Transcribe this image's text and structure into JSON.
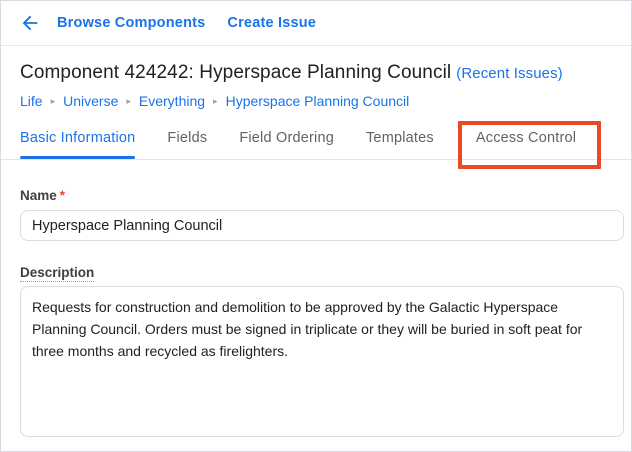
{
  "topbar": {
    "back_icon": "arrow-left",
    "browse_components_label": "Browse Components",
    "create_issue_label": "Create Issue"
  },
  "header": {
    "title": "Component 424242: Hyperspace Planning Council",
    "recent_issues_label": "(Recent Issues)"
  },
  "breadcrumb": {
    "separator": "▸",
    "items": [
      "Life",
      "Universe",
      "Everything",
      "Hyperspace Planning Council"
    ]
  },
  "tabs": {
    "items": [
      {
        "label": "Basic Information",
        "active": true
      },
      {
        "label": "Fields",
        "active": false
      },
      {
        "label": "Field Ordering",
        "active": false
      },
      {
        "label": "Templates",
        "active": false
      },
      {
        "label": "Access Control",
        "active": false,
        "highlighted": true
      }
    ]
  },
  "form": {
    "name": {
      "label": "Name",
      "required_marker": "*",
      "value": "Hyperspace Planning Council"
    },
    "description": {
      "label": "Description",
      "value": "Requests for construction and demolition to be approved by the Galactic Hyperspace Planning Council. Orders must be signed in triplicate or they will be buried in soft peat for three months and recycled as firelighters."
    }
  },
  "annotation": {
    "type": "highlight-box",
    "target_tab": "Access Control"
  },
  "colors": {
    "link_blue": "#1a73e8",
    "active_tab_blue": "#1a73e8",
    "inactive_tab_gray": "#5f6368",
    "annotation_red": "#e84b23",
    "required_red": "#e8453c",
    "input_border": "#dadce0",
    "title_text": "#202124"
  }
}
